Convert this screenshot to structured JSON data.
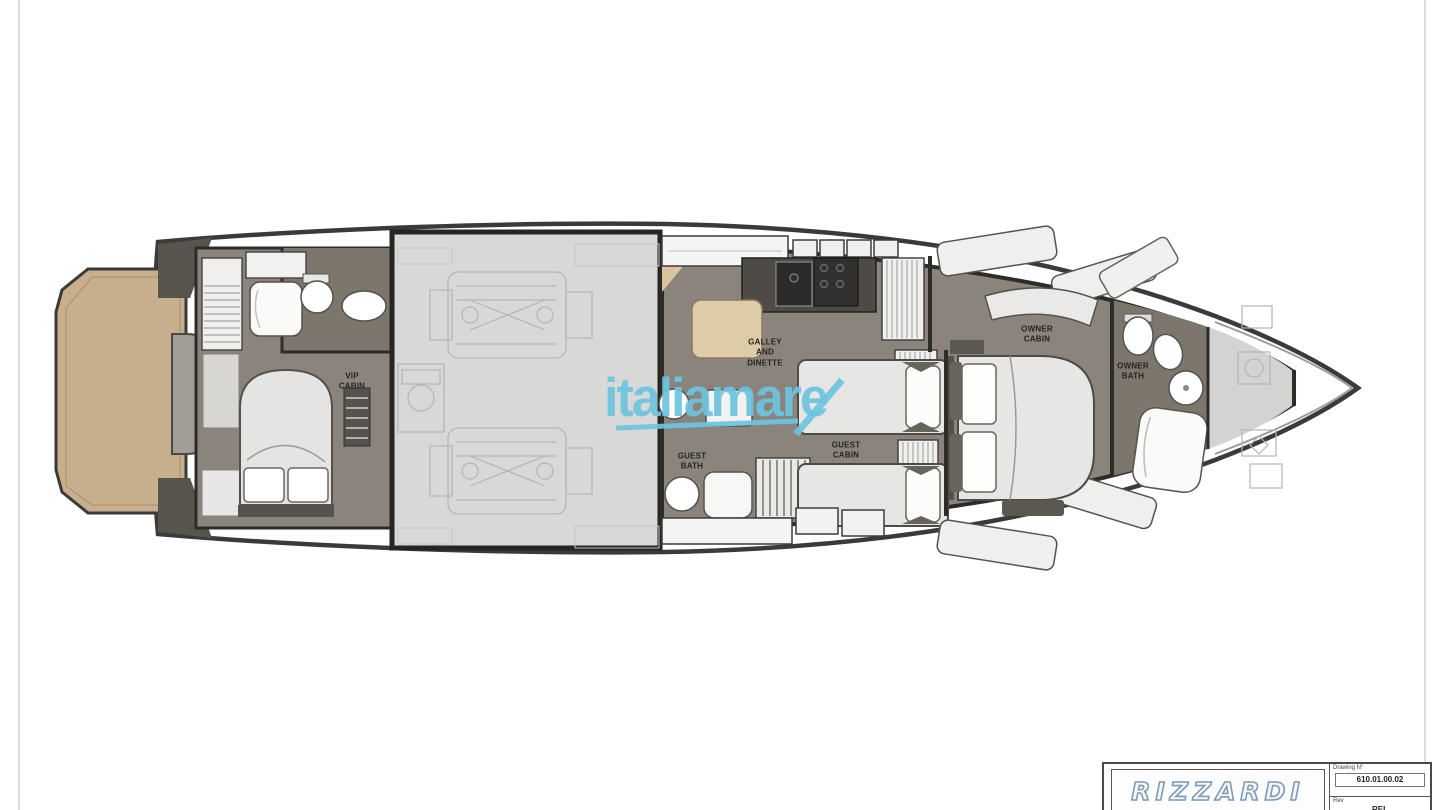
{
  "plan": {
    "rooms": [
      {
        "id": "vip-cabin",
        "label": "VIP\nCABIN"
      },
      {
        "id": "galley",
        "label": "GALLEY\nAND\nDINETTE"
      },
      {
        "id": "guest-bath",
        "label": "GUEST\nBATH"
      },
      {
        "id": "guest-cabin",
        "label": "GUEST\nCABIN"
      },
      {
        "id": "owner-cabin",
        "label": "OWNER\nCABIN"
      },
      {
        "id": "owner-bath",
        "label": "OWNER\nBATH"
      }
    ]
  },
  "watermark": {
    "text": "italiamare"
  },
  "titleblock": {
    "brand": "RIZZARDI",
    "drawing_label": "Drawing N°",
    "drawing_number": "610.01.00.02",
    "rev_label": "Rev",
    "rev_value": "REL"
  },
  "colors": {
    "c-accent": "#6ec4e0",
    "c-platform": "#c7ae8c",
    "c-floor": "#8a847c",
    "c-floor-dark": "#7c766d",
    "c-engine": "#d8d8d6",
    "c-forepeak": "#d3d3d1",
    "c-hull": "#3a3a3a"
  }
}
